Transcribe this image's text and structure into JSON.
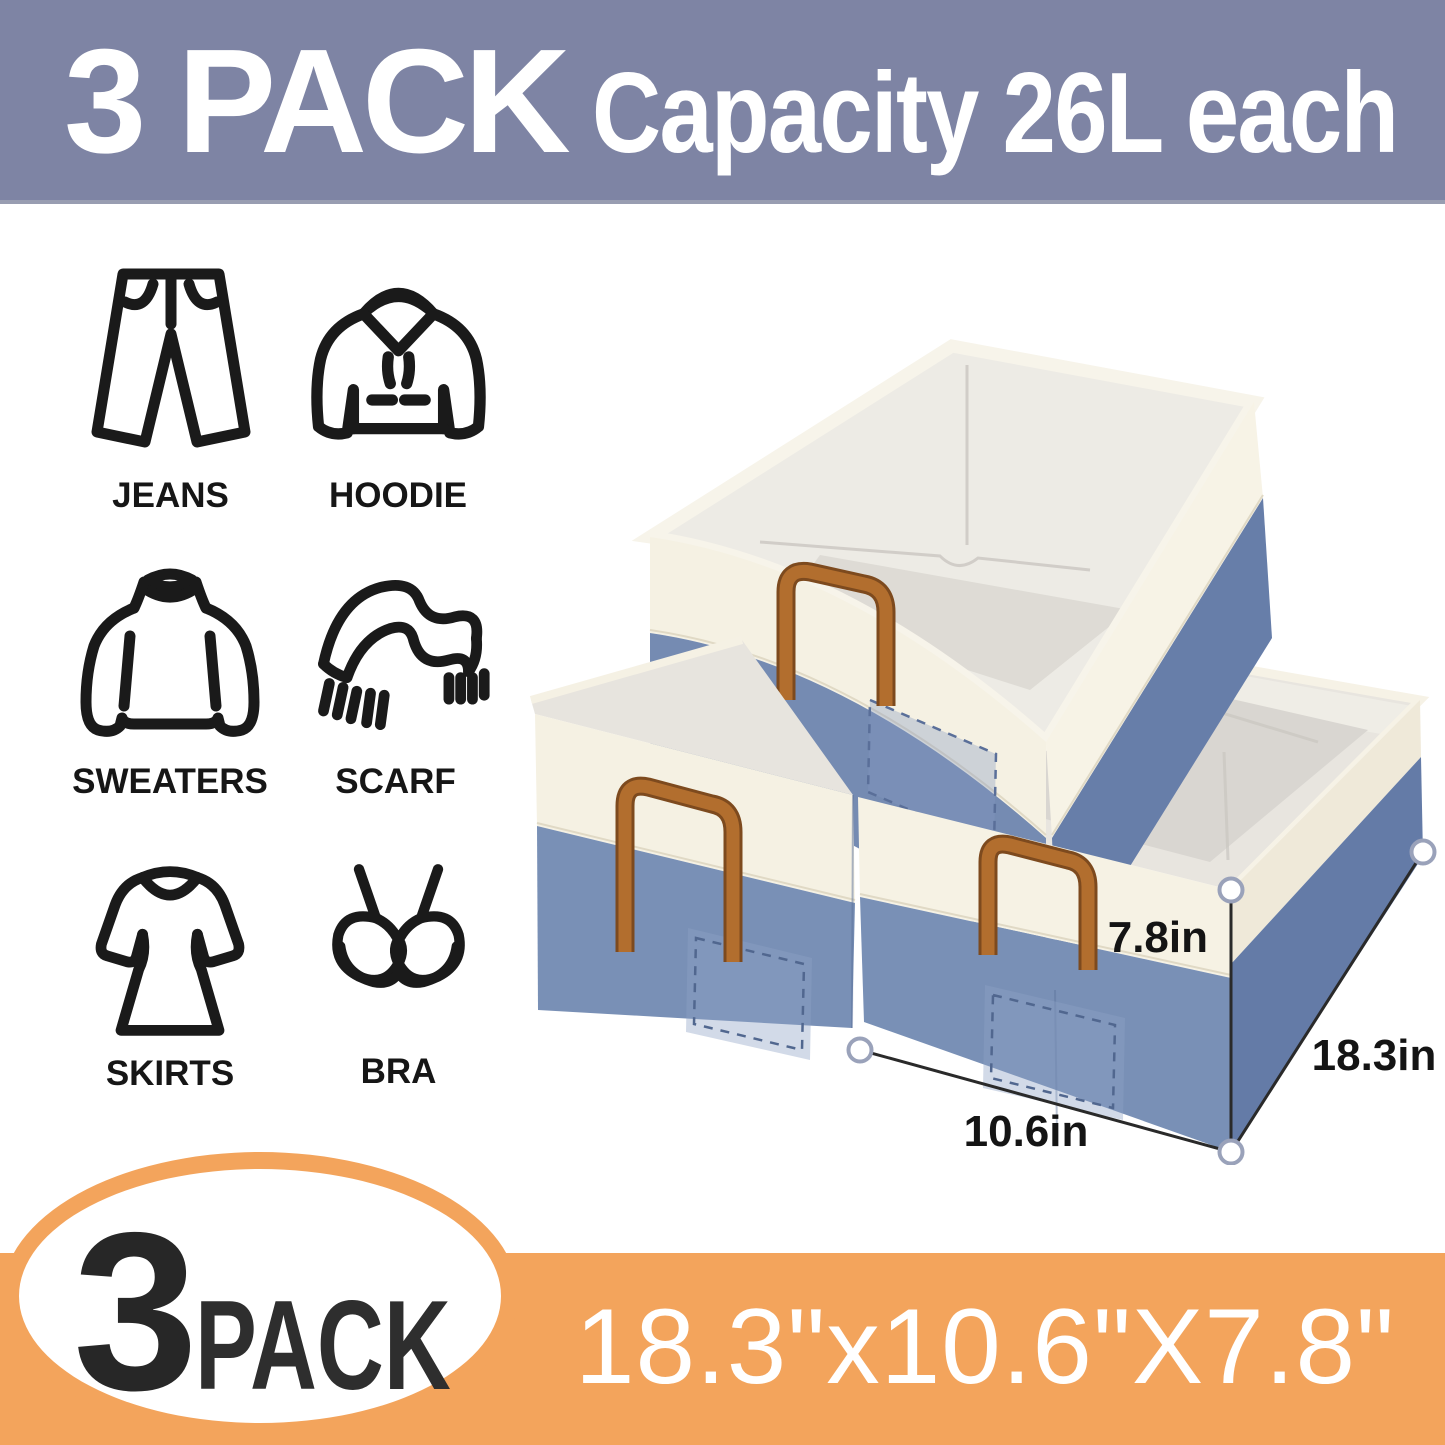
{
  "banner": {
    "bg_color": "#7e84a4",
    "pack_label": "3 PACK",
    "capacity_label": "Capacity 26L each"
  },
  "categories": [
    {
      "label": "JEANS"
    },
    {
      "label": "HOODIE"
    },
    {
      "label": "SWEATERS"
    },
    {
      "label": "SCARF"
    },
    {
      "label": "SKIRTS"
    },
    {
      "label": "BRA"
    }
  ],
  "product": {
    "bin_count": 3,
    "dimensions": {
      "height": "7.8in",
      "depth": "18.3in",
      "width": "10.6in"
    },
    "colors": {
      "bin_blue": "#7990b6",
      "bin_cream": "#f5f1e3",
      "handle_brown": "#b26e2e",
      "interior_gray": "#e8e5df"
    }
  },
  "footer": {
    "accent_color": "#f3a45c",
    "pack_count": "3",
    "pack_word": "PACK",
    "size_label": "18.3\"x10.6\"X7.8\""
  }
}
